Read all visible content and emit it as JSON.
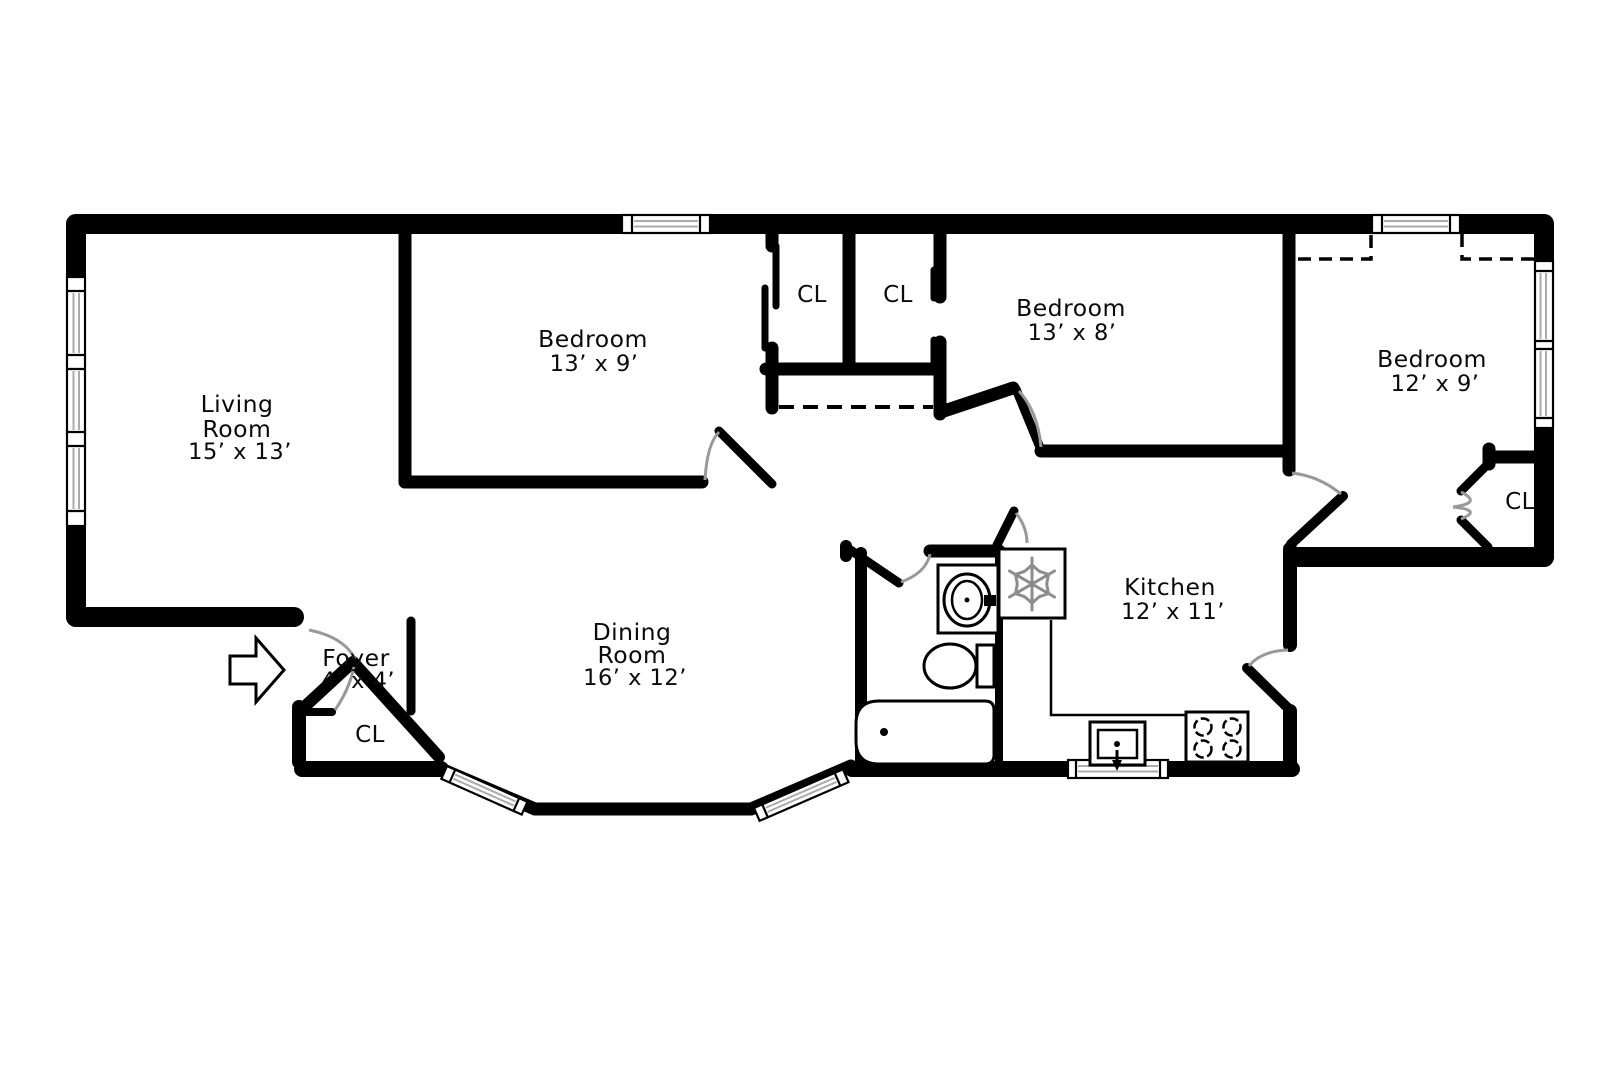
{
  "plan_type": "apartment-floor-plan",
  "colors": {
    "background": "#ffffff",
    "wall": "#000000",
    "window_glazing": "#ababab",
    "door_arc": "#999999",
    "snowflake": "#8c8c8c"
  },
  "rooms": {
    "living_room": {
      "name_line1": "Living",
      "name_line2": "Room",
      "dims": "15’ x 13’"
    },
    "bedroom_left": {
      "name": "Bedroom",
      "dims": "13’ x 9’"
    },
    "bedroom_middle": {
      "name": "Bedroom",
      "dims": "13’ x 8’"
    },
    "bedroom_right": {
      "name": "Bedroom",
      "dims": "12’ x 9’"
    },
    "kitchen": {
      "name": "Kitchen",
      "dims": "12’ x 11’"
    },
    "dining_room": {
      "name_line1": "Dining",
      "name_line2": "Room",
      "dims": "16’ x 12’"
    },
    "foyer": {
      "name": "Foyer",
      "dims": "4’ x 4’"
    }
  },
  "closets": {
    "hall_closet_left": "CL",
    "hall_closet_right": "CL",
    "bedroom_right_closet": "CL",
    "foyer_closet": "CL"
  },
  "icons": {
    "entry": "entry-direction-arrow",
    "refrigerator": "snowflake",
    "bathroom_sink": "vanity-sink",
    "toilet": "toilet",
    "bathtub": "bathtub",
    "kitchen_sink": "kitchen-sink",
    "stove": "four-burner-stove"
  }
}
